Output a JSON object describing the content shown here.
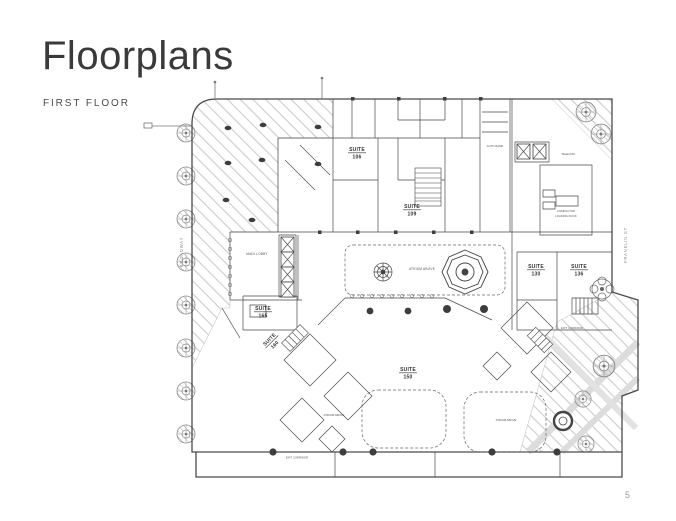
{
  "page": {
    "title": "Floorplans",
    "subtitle": "FIRST FLOOR",
    "page_number": "5"
  },
  "floorplan": {
    "streets": {
      "left": "BROADWAY",
      "right": "FRANKLIN ST"
    },
    "suites": [
      {
        "label": "SUITE",
        "number": "106"
      },
      {
        "label": "SUITE",
        "number": "109"
      },
      {
        "label": "SUITE",
        "number": "130"
      },
      {
        "label": "SUITE",
        "number": "136"
      },
      {
        "label": "SUITE",
        "number": "165"
      },
      {
        "label": "SUITE",
        "number": "160"
      },
      {
        "label": "SUITE",
        "number": "150"
      }
    ],
    "labels": {
      "main_lobby": "MAIN LOBBY",
      "atrium_above": "ATRIUM ABOVE",
      "auto_ramp": "AUTO RAMP",
      "compactor": "COMPACTOR",
      "loading_dock": "LOADING DOCK",
      "telecom": "TELECOM",
      "exit_corridor": "EXIT CORRIDOR"
    },
    "colors": {
      "wall": "#4a4a4a",
      "hatch": "#cccccc",
      "band": "#d9d9d9"
    }
  }
}
